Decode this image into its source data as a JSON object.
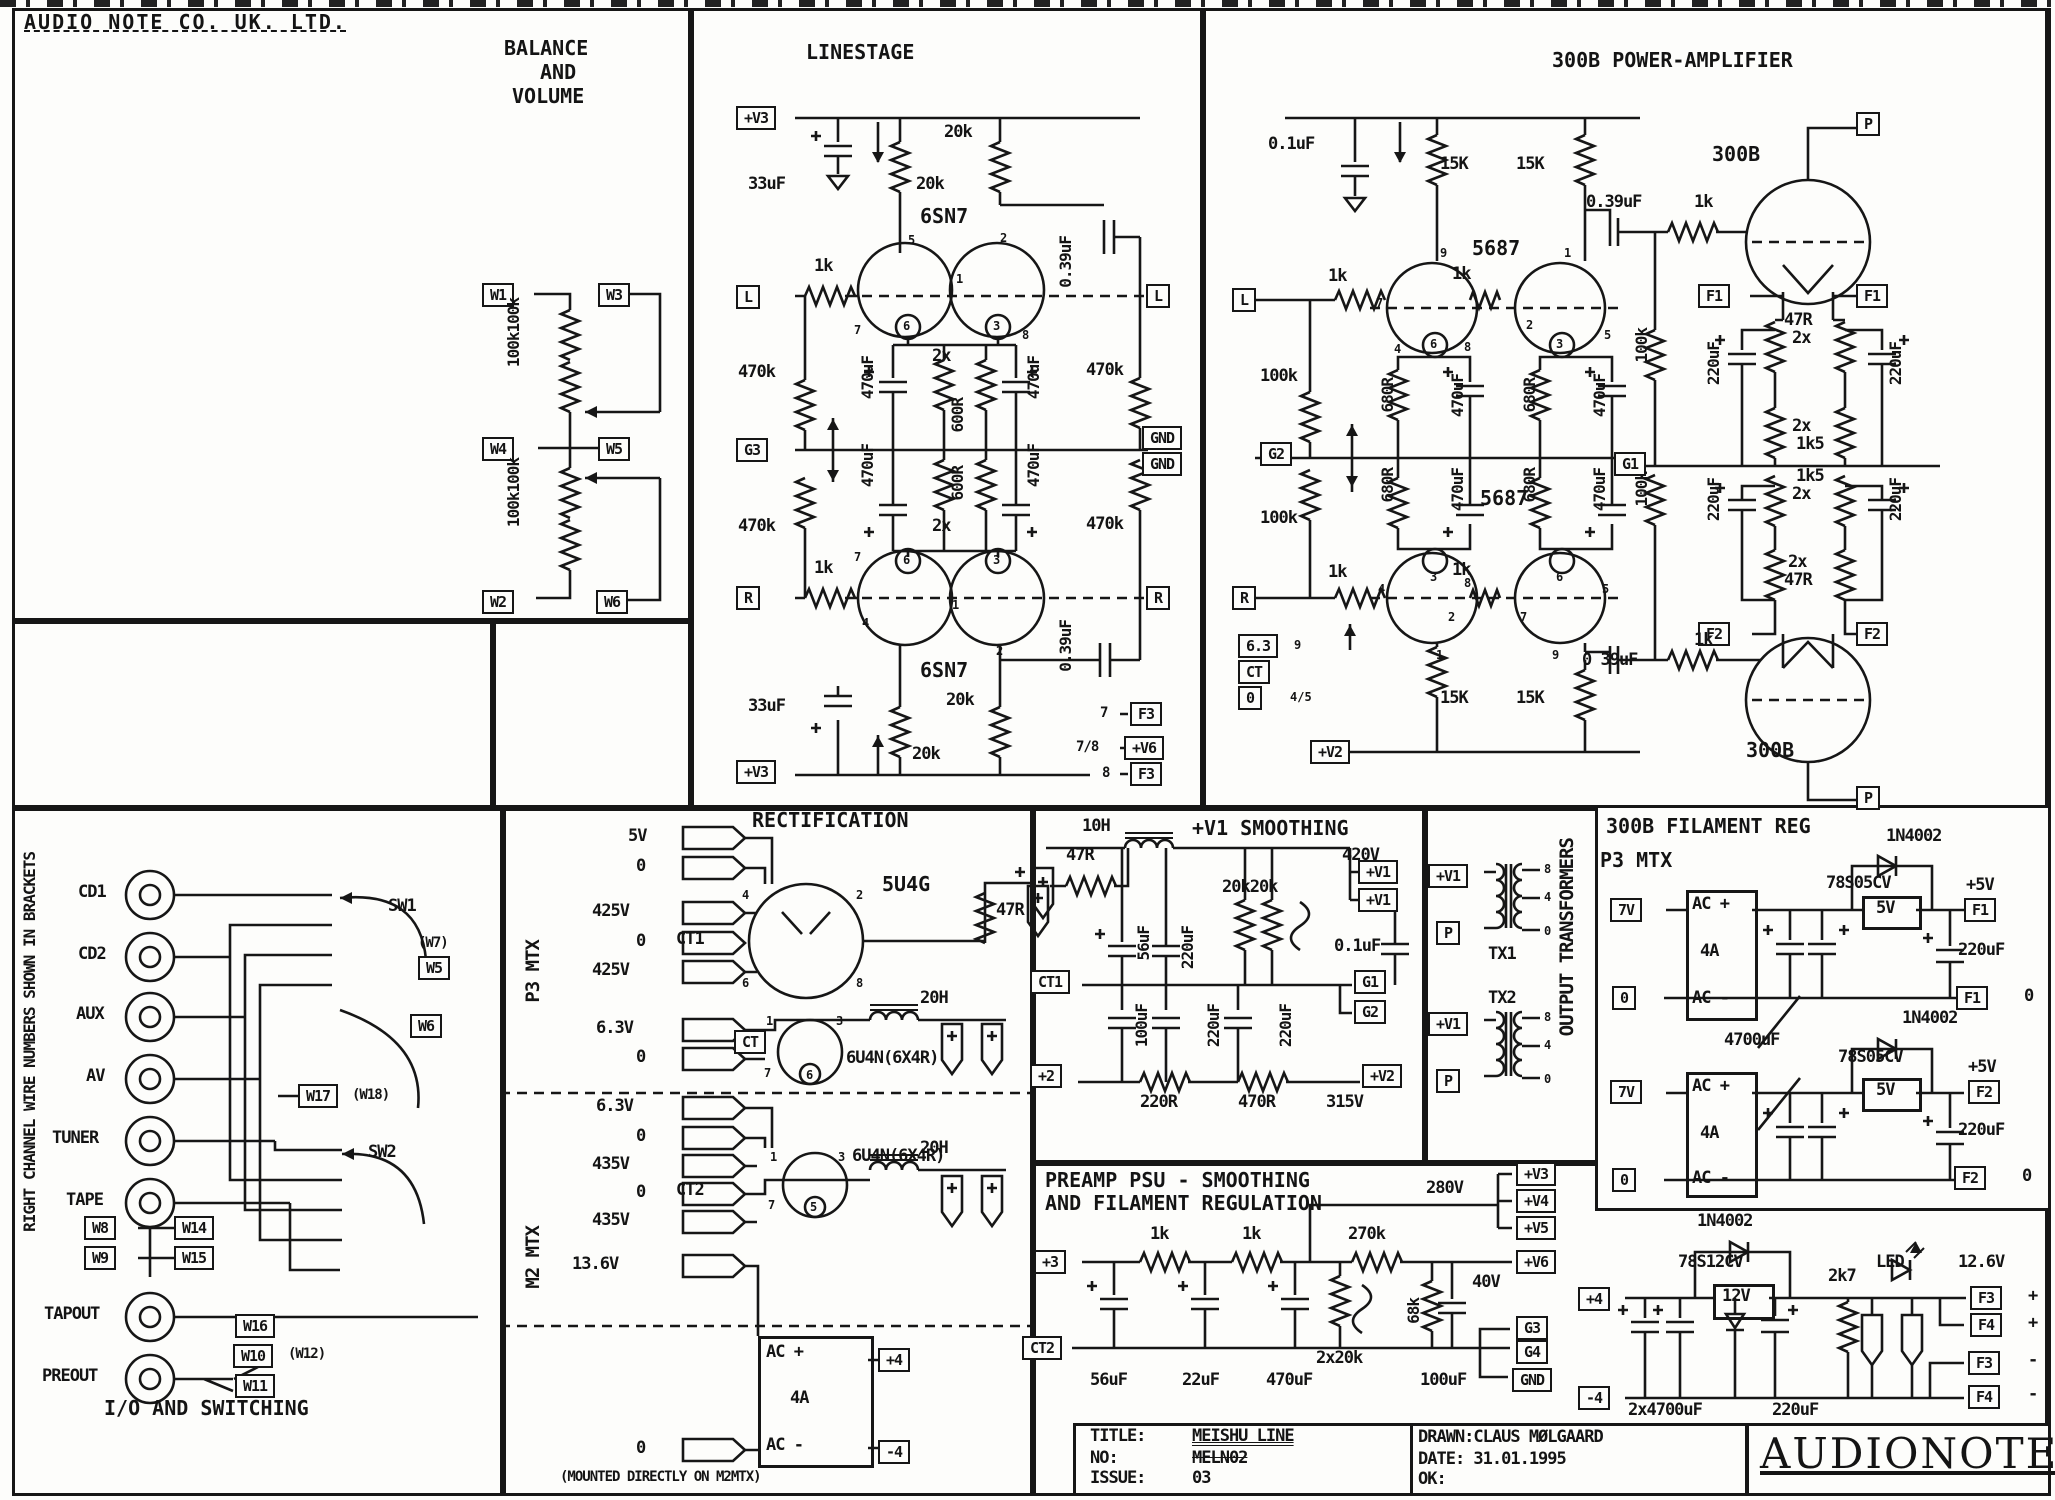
{
  "h": {
    "company": "AUDIO NOTE CO. UK. LTD."
  },
  "ba": {
    "t1": "BALANCE",
    "t2": "AND",
    "t3": "VOLUME",
    "w1": "W1",
    "w3": "W3",
    "w4": "W4",
    "w5": "W5",
    "w2": "W2",
    "w6": "W6",
    "ru": "100k100k",
    "rl": "100k100k"
  },
  "ls": {
    "title": "LINESTAGE",
    "vtop": "+V3",
    "ctop": "33uF",
    "rt1": "20k",
    "rt2": "20k",
    "tt": "6SN7",
    "inl": "L",
    "rk1": "1k",
    "riu": "470k",
    "g3": "G3",
    "ril": "470k",
    "inr": "R",
    "rk2": "1k",
    "tb": "6SN7",
    "cbot": "33uF",
    "rb1": "20k",
    "rb2": "20k",
    "vbot": "+V3",
    "outl": "L",
    "rou": "470k",
    "gnd1": "GND",
    "gnd2": "GND",
    "rol": "470k",
    "outr": "R",
    "c39u": "0.39uF",
    "c39l": "0.39uF",
    "cc": [
      "470uF",
      "470uF",
      "470uF",
      "470uF"
    ],
    "x2u": "2x",
    "x2l": "2x",
    "r6u": "600R",
    "r6l": "600R",
    "n7": "7",
    "n78": "7/8",
    "n8": "8",
    "f3a": "F3",
    "v6": "+V6",
    "f3b": "F3",
    "pt": [
      "5",
      "2",
      "1",
      "7",
      "6",
      "3",
      "8"
    ],
    "pb": [
      "7",
      "6",
      "3",
      "4",
      "1",
      "2"
    ]
  },
  "am": {
    "title": "300B POWER-AMPLIFIER",
    "c01": "0.1uF",
    "r15a": "15K",
    "r15b": "15K",
    "tt": "5687",
    "tbl": "5687",
    "inl": "L",
    "inr": "R",
    "k": [
      "1k",
      "1k",
      "1k",
      "1k"
    ],
    "ra": "100k",
    "rb": "100k",
    "g2": "G2",
    "r680": [
      "680R",
      "680R",
      "680R",
      "680R"
    ],
    "c470": [
      "470uF",
      "470uF",
      "470uF",
      "470uF"
    ],
    "rv": [
      "100k",
      "100k"
    ],
    "g1": "G1",
    "cu": "0.39uF",
    "ku": "1k",
    "cl": "0 39uF",
    "kl": "1k",
    "t3u": "300B",
    "t3l": "300B",
    "pu": "P",
    "pl": "P",
    "f1a": "F1",
    "f1b": "F1",
    "f2a": "F2",
    "f2b": "F2",
    "r47u": "47R",
    "x2a": "2x",
    "x2b": "2x",
    "k15a": "1k5",
    "k15b": "1k5",
    "x2c": "2x",
    "x2d": "2x",
    "r47l": "47R",
    "c220": [
      "220uF",
      "220uF",
      "220uF",
      "220uF"
    ],
    "h63": "6.3",
    "h9": "9",
    "hct": "CT",
    "h0": "0",
    "h45": "4/5",
    "r15c": "15K",
    "r15d": "15K",
    "v2": "+V2",
    "pt": [
      "9",
      "7",
      "4",
      "6",
      "8",
      "2",
      "1",
      "3",
      "5"
    ],
    "pb": [
      "4",
      "3",
      "8",
      "6",
      "5",
      "2",
      "7",
      "1",
      "9"
    ]
  },
  "re": {
    "title": "RECTIFICATION",
    "p3": "P3 MTX",
    "m2": "M2 MTX",
    "wa": [
      "5V",
      "0",
      "425V",
      "0",
      "425V",
      "6.3V",
      "0"
    ],
    "ct1": "CT1",
    "wb": [
      "6.3V",
      "0",
      "435V",
      "0",
      "435V"
    ],
    "ct2": "CT2",
    "v136": "13.6V",
    "z0": "0",
    "tub": "5U4G",
    "r47": "47R",
    "ch1": "20H",
    "ch2": "20H",
    "tu1": "6U4N(6X4R)",
    "tu2": "6U4N(6X4R)",
    "ct": "CT",
    "acp": "AC +",
    "a4": "4A",
    "acm": "AC -",
    "p4": "+4",
    "m4": "-4",
    "note": "(MOUNTED DIRECTLY ON M2MTX)",
    "pa": [
      "4",
      "6",
      "2",
      "8"
    ],
    "pb": [
      "1",
      "7",
      "3",
      "6"
    ],
    "pc": [
      "1",
      "7",
      "3",
      "5"
    ]
  },
  "sm": {
    "title": "+V1 SMOOTHING",
    "ch": "10H",
    "r47": "47R",
    "c56": "56uF",
    "c220a": "220uF",
    "c100": "100uF",
    "c220b": "220uF",
    "c220c": "220uF",
    "r20": "20k20k",
    "v420": "420V",
    "v1a": "+V1",
    "v1b": "+V1",
    "c01": "0.1uF",
    "g1": "G1",
    "g2": "G2",
    "ct1": "CT1",
    "p2": "+2",
    "r220": "220R",
    "r470": "470R",
    "v315": "315V",
    "v2": "+V2"
  },
  "xf": {
    "title": "OUTPUT TRANSFORMERS",
    "v1a": "+V1",
    "pa": "P",
    "tx1": "TX1",
    "ta": [
      "8",
      "4",
      "0"
    ],
    "tx2": "TX2",
    "v1b": "+V1",
    "pb": "P",
    "tb": [
      "8",
      "4",
      "0"
    ]
  },
  "fi": {
    "title": "300B FILAMENT REG",
    "d1": "1N4002",
    "d2": "1N4002",
    "p3": "P3 MTX",
    "v7a": "7V",
    "v7b": "7V",
    "z0a": "0",
    "z0b": "0",
    "acpa": "AC +",
    "acma": "AC -",
    "acpb": "AC +",
    "acmb": "AC -",
    "a4a": "4A",
    "a4b": "4A",
    "rg1": "78S05CV",
    "rg2": "78S05CV",
    "b5a": "5V",
    "b5b": "5V",
    "p5a": "+5V",
    "p5b": "+5V",
    "f1": "F1",
    "f1r": "F1",
    "f1z": "0",
    "f2": "F2",
    "f2r": "F2",
    "f2z": "0",
    "c2a": "220uF",
    "c2b": "220uF",
    "c47": "4700uF"
  },
  "ps": {
    "t1": "PREAMP PSU - SMOOTHING",
    "t2": "AND FILAMENT REGULATION",
    "v280": "280V",
    "v3": "+V3",
    "v4": "+V4",
    "v5": "+V5",
    "v6": "+V6",
    "v40": "40V",
    "p3": "+3",
    "k1a": "1k",
    "k1b": "1k",
    "r270": "270k",
    "r68": "68k",
    "r2x": "2x20k",
    "g3": "G3",
    "g4": "G4",
    "gnd": "GND",
    "ct2": "CT2",
    "c56": "56uF",
    "c22": "22uF",
    "c470": "470uF",
    "c100": "100uF",
    "p4": "+4",
    "d": "1N4002",
    "rg": "78S12CV",
    "b12": "12V",
    "r27": "2k7",
    "led": "LED",
    "v126": "12.6V",
    "f3a": "F3",
    "pp1": "+",
    "f4a": "F4",
    "pp2": "+",
    "f3b": "F3",
    "mm1": "-",
    "f4b": "F4",
    "mm2": "-",
    "m4": "-4",
    "c47": "2x4700uF",
    "c220": "220uF"
  },
  "io": {
    "note": "RIGHT CHANNEL WIRE NUMBERS SHOWN IN BRACKETS",
    "jacks": [
      "CD1",
      "CD2",
      "AUX",
      "AV",
      "TUNER",
      "TAPE",
      "TAPOUT",
      "PREOUT"
    ],
    "sw1": "SW1",
    "sw2": "SW2",
    "w7": "(W7)",
    "w5": "W5",
    "w6": "W6",
    "w17": "W17",
    "w18": "(W18)",
    "w8": "W8",
    "w14": "W14",
    "w9": "W9",
    "w15": "W15",
    "w16": "W16",
    "w10": "W10",
    "w12": "(W12)",
    "w11": "W11",
    "cap": "I/O AND SWITCHING"
  },
  "tb": {
    "lt": "TITLE:",
    "title": "MEISHU LINE",
    "ln": "NO:",
    "no": "MELN02",
    "li": "ISSUE:",
    "issue": "03",
    "drawn": "DRAWN:CLAUS MØLGAARD",
    "date": "DATE: 31.01.1995",
    "ok": "OK:",
    "logo": "AUDIONOTE"
  }
}
